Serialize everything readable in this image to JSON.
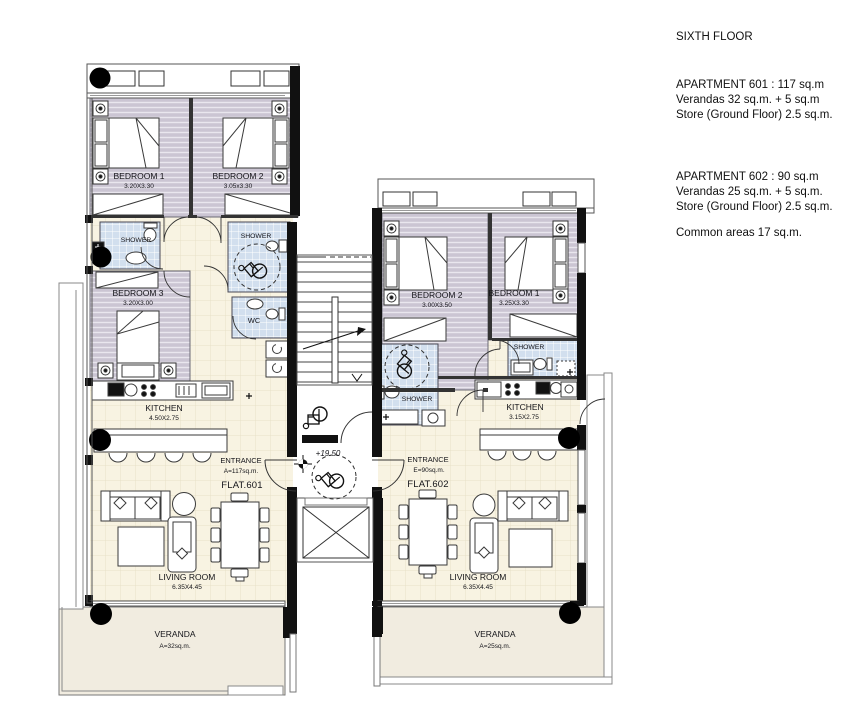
{
  "panel": {
    "floor": "SIXTH FLOOR",
    "apt601_line1": "APARTMENT 601 : 117 sq.m",
    "apt601_line2": "Verandas 32 sq.m. + 5 sq.m",
    "apt601_line3": "Store (Ground Floor) 2.5 sq.m.",
    "apt602_line1": "APARTMENT 602 : 90 sq.m",
    "apt602_line2": "Verandas 25 sq.m. + 5 sq.m.",
    "apt602_line3": "Store (Ground Floor) 2.5 sq.m.",
    "common": "Common areas 17 sq.m."
  },
  "flat601": {
    "bedroom1_name": "BEDROOM 1",
    "bedroom1_dims": "3.20X3.30",
    "bedroom2_name": "BEDROOM 2",
    "bedroom2_dims": "3.05x3.30",
    "bedroom3_name": "BEDROOM 3",
    "bedroom3_dims": "3.20X3.00",
    "shower1": "SHOWER",
    "shower2": "SHOWER",
    "wc": "WC",
    "kitchen_name": "KITCHEN",
    "kitchen_dims": "4.50X2.75",
    "living_name": "LIVING ROOM",
    "living_dims": "6.35X4.45",
    "entrance_label": "ENTRANCE",
    "entrance_area": "A=117sq.m.",
    "flat_label": "FLAT.601",
    "veranda_name": "VERANDA",
    "veranda_area": "A=32sq.m."
  },
  "flat602": {
    "bedroom1_name": "BEDROOM 1",
    "bedroom1_dims": "3.25X3.30",
    "bedroom2_name": "BEDROOM 2",
    "bedroom2_dims": "3.00X3.50",
    "shower1": "SHOWER",
    "shower2": "SHOWER",
    "kitchen_name": "KITCHEN",
    "kitchen_dims": "3.15X2.75",
    "living_name": "LIVING ROOM",
    "living_dims": "6.35X4.45",
    "entrance_label": "ENTRANCE",
    "entrance_area": "E=90sq.m.",
    "flat_label": "FLAT.602",
    "veranda_name": "VERANDA",
    "veranda_area": "A=25sq.m."
  },
  "core": {
    "level": "+19.50"
  },
  "icons": {
    "wheelchair_icon": "accessibility-wheelchair-symbol",
    "level_marker_icon": "elevation-datum-target",
    "column_icon": "structural-column-dot",
    "stairs_icon": "staircase-up-arrow",
    "elevator_icon": "elevator-shaft-x"
  },
  "colors": {
    "bedroom_floor": "#cbc5d3",
    "tile_floor": "#f8f3e2",
    "bath_floor": "#d2dfee",
    "veranda_floor": "#f1ece0",
    "wall": "#111111"
  }
}
